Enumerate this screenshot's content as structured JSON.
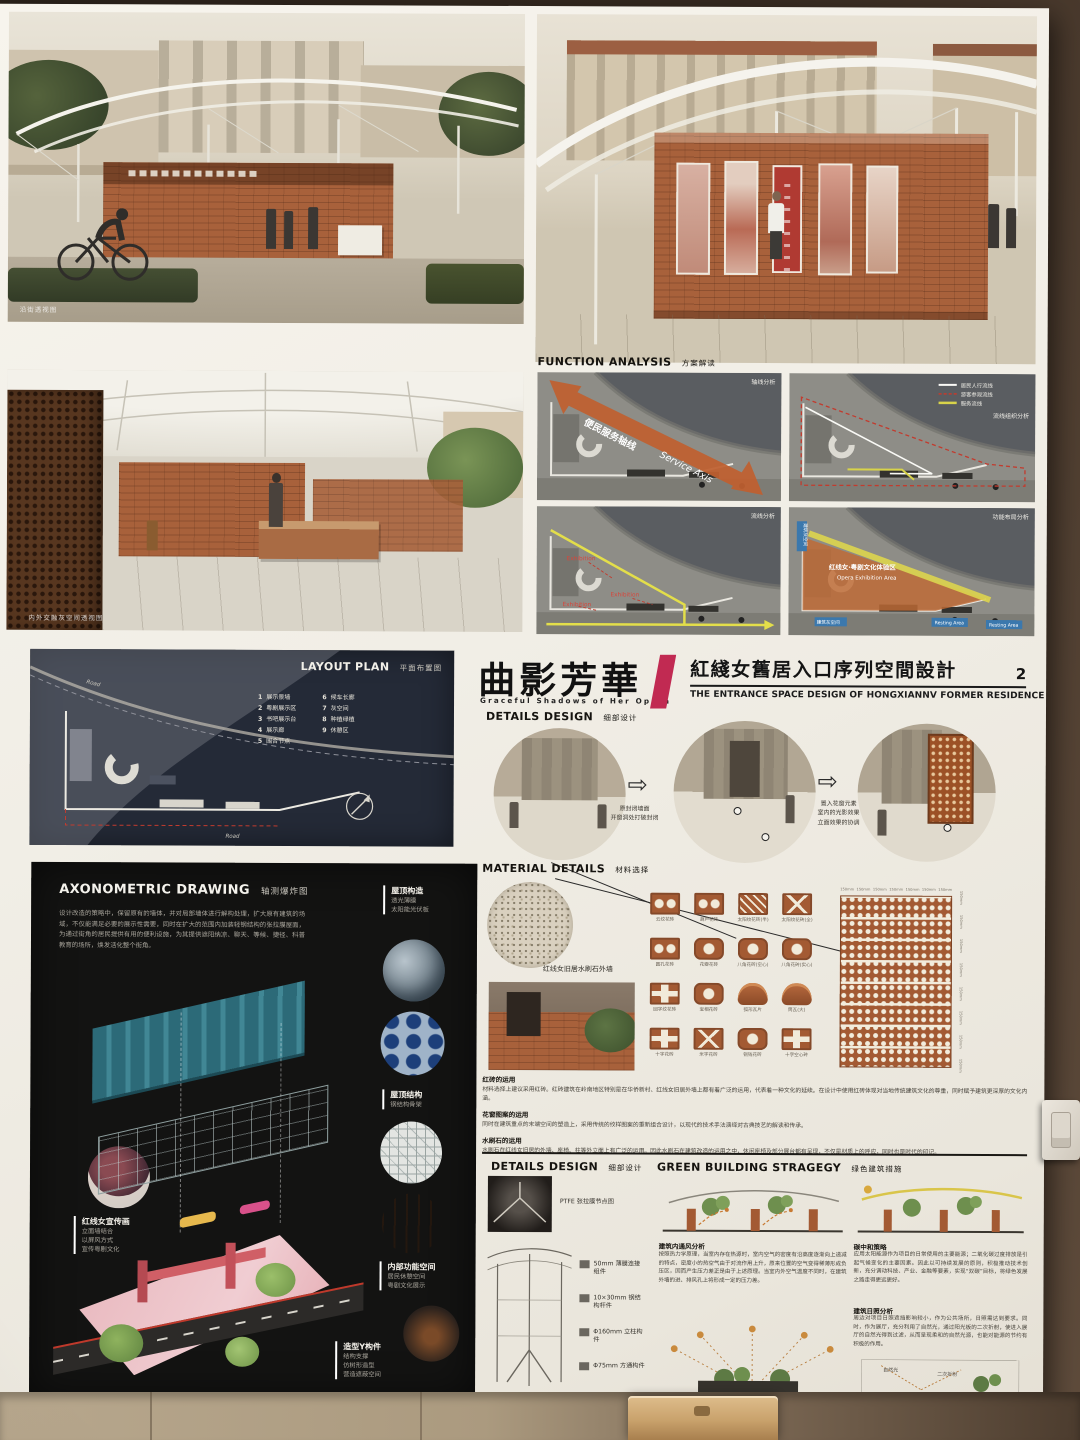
{
  "poster": {
    "title_block": {
      "main_cn": "曲影芳華",
      "main_en": "Graceful Shadows of Her Opera",
      "project_cn": "紅綫女舊居入口序列空間設計",
      "project_en": "THE ENTRANCE SPACE DESIGN OF HONGXIANNV FORMER RESIDENCE",
      "page": "2"
    },
    "renders": {
      "street_caption": "沿街透视图",
      "interior_caption": "内外交融灰空间透视图"
    },
    "function_analysis": {
      "title": "FUNCTION ANALYSIS",
      "title_cn": "方案解读",
      "panels": [
        {
          "corner": "轴线分析",
          "axis_cn": "便民服务轴线",
          "axis_en": "Service Axis"
        },
        {
          "corner": "流线组织分析",
          "legend": [
            "居民人行流线",
            "游客参观流线",
            "服务流线"
          ]
        },
        {
          "corner": "流线分析",
          "tag": "Exhibition"
        },
        {
          "corner": "功能布局分析",
          "area_cn": "红线女·粤剧文化体验区",
          "area_en": "Opera Exhibition Area",
          "resting": "Resting Area",
          "gray_tag": "建筑灰空间"
        }
      ]
    },
    "layout_plan": {
      "title": "LAYOUT PLAN",
      "title_cn": "平面布置图",
      "road_label": "Road",
      "legend": [
        {
          "num": "1",
          "label": "展示景墙"
        },
        {
          "num": "2",
          "label": "粤剧展示区"
        },
        {
          "num": "3",
          "label": "书吧展示台"
        },
        {
          "num": "4",
          "label": "展示廊"
        },
        {
          "num": "5",
          "label": "围合节点"
        },
        {
          "num": "6",
          "label": "候车长廊"
        },
        {
          "num": "7",
          "label": "灰空间"
        },
        {
          "num": "8",
          "label": "种植绿植"
        },
        {
          "num": "9",
          "label": "休憩区"
        }
      ]
    },
    "details_design": {
      "title": "DETAILS DESIGN",
      "title_cn": "细部设计",
      "step1": [
        "原封闭墙面",
        "开窗洞处打破封闭"
      ],
      "step2": [
        "置入花窗元素",
        "室内的光影效果",
        "立面效果的协调"
      ]
    },
    "material": {
      "title": "MATERIAL DETAILS",
      "title_cn": "材料选择",
      "sample_label": "红线女旧居水刷石外墙",
      "panel_dim": "150mm",
      "grid": [
        "云纹花砖",
        "葫芦花砖",
        "太阳纹花砖(半)",
        "太阳纹花砖(全)",
        "圆孔花砖",
        "花瓣花砖",
        "八角花砖(空心)",
        "八角花砖(实心)",
        "回字纹花砖",
        "宝相花砖",
        "弧形瓦片",
        "筒瓦(大)",
        "十字花砖",
        "米字花砖",
        "铜钱花砖",
        "十字空心砖"
      ],
      "paragraphs": [
        {
          "heading": "红砖的运用",
          "body": "材料选择上建议采用红砖。红砖建筑在岭南地区特别是在华侨新村、红线女旧居外墙上都有着广泛的运用，代表着一种文化的延续。在设计中使用红砖体现对当地传统建筑文化的尊重，同时赋予建筑更深厚的文化内涵。"
        },
        {
          "heading": "花窗图案的运用",
          "body": "同时在建筑重点的末端空间的塑造上，采用传统的纹样图案的重新组合设计，以现代的技术手法演绎对古典技艺的解读和传承。"
        },
        {
          "heading": "水刷石的运用",
          "body": "水刷石在红线女旧居的外墙、座椅、柱等外立面上有广泛的运用。因此水刷石在建筑改造的运用之中，休闲座椅及部分展台都有呈现，不仅是材质上的呼应，同时也是时代的印记。"
        }
      ]
    },
    "axonometric": {
      "title": "AXONOMETRIC DRAWING",
      "title_cn": "轴测爆炸图",
      "intro": "设计改造的策略中，保留原有的墙体，并对局部墙体进行解构处理，扩大原有建筑的场域，不仅能满足必要的展示性需要，同时在扩大的范围内加装轻钢结构的张拉膜屋面，为通过街角的居民提供有用的便利设施，为其提供遮阳纳凉、聊天、等候、捷径、科普教育的场所，焕发活化整个街角。",
      "roof_construction": {
        "heading": "屋顶构造",
        "lines": [
          "透光薄膜",
          "太阳能光伏板"
        ]
      },
      "roof_structure": {
        "heading": "屋顶结构",
        "lines": [
          "钢结构骨架"
        ]
      },
      "interior": {
        "heading": "内部功能空间",
        "lines": [
          "居民休憩空间",
          "粤剧文化展示"
        ]
      },
      "promo": {
        "heading": "红线女宣传画",
        "lines": [
          "立面墙结合",
          "以屏风方式",
          "宣传粤剧文化"
        ]
      },
      "y_member": {
        "heading": "造型Y构件",
        "lines": [
          "结构支撑",
          "仿树形造型",
          "营造遮蔽空间"
        ]
      }
    },
    "details_nodes": {
      "title": "DETAILS DESIGN",
      "title_cn": "细部设计",
      "items": [
        "PTFE 张拉膜节点图",
        "50mm 薄膜连接组件",
        "10×30mm 钢结构杆件",
        "Φ160mm 立柱构件",
        "Φ75mm 方通构件"
      ]
    },
    "green": {
      "title": "GREEN BUILDING STRAGEGY",
      "title_cn": "绿色建筑措施",
      "ventilation": {
        "heading": "建筑内通风分析",
        "body": "按照热力学原理，当室内存在热源时，室内空气的密度有沿高度逐渐向上递减的特点，密度小的热空气由于对流作用上升，原来位置的空气变得稀薄形成负压区，因而产生压力差正是由于上述原理。当室内外空气温度不同时，在建筑外墙的进、排风孔上将形成一定的压力差。"
      },
      "carbon": {
        "heading": "碳中和策略",
        "body": "应用太阳能源作为项目的日常使用的主要能源；二氧化碳过度排放是引起气候变化的主要因素。因此以可持续发展的原则，积极推动技术创新，充分调动科技、产业、金融等要素，实现“双碳”目标，将绿色发展之路走得更远更好。"
      },
      "sunlight": {
        "heading": "建筑日照分析",
        "body": "周边对项目日照遮挡影响较小，作为公共场所，日照需达到要求。同时，作为展厅，充分利用了自然光，通过阳光板的二次折射，使进入展厅的自然光得到过滤，从而呈现柔和的自然光源，也能对能源的节约有积极的作用。",
        "diagram_labels": [
          "自然光",
          "二次折射"
        ]
      }
    }
  }
}
